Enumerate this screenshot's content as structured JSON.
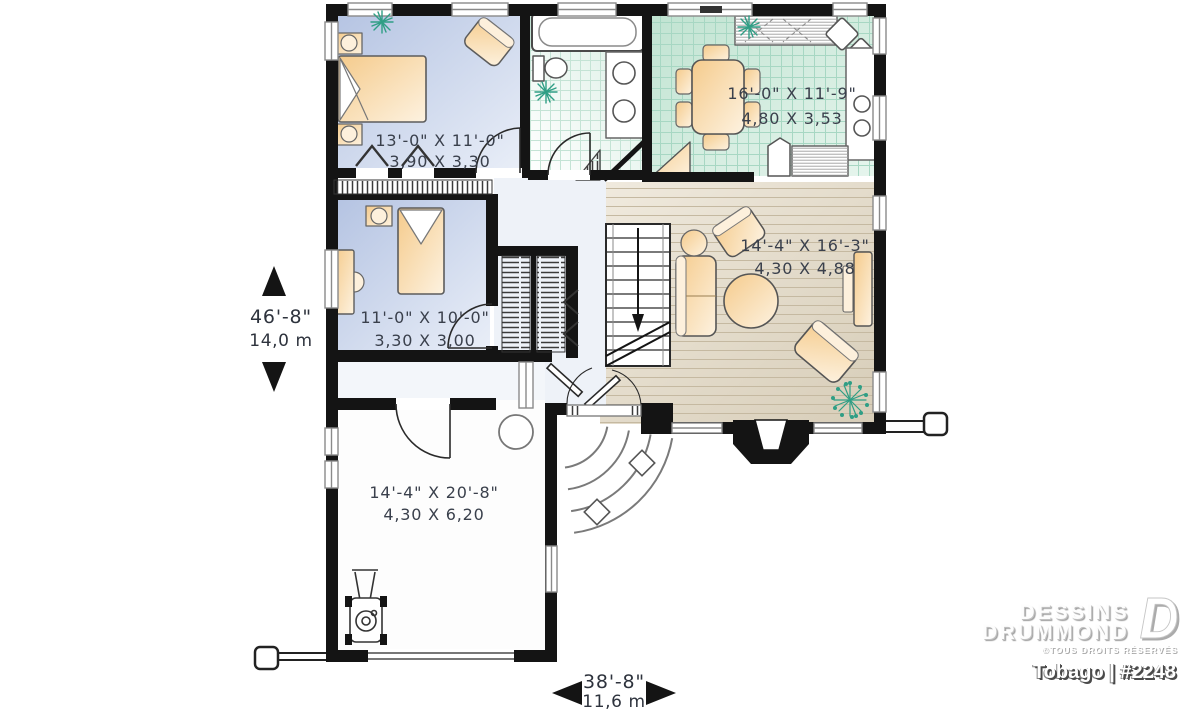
{
  "rooms": {
    "bedroom1": {
      "imperial": "13'-0\" X 11'-0\"",
      "metric": "3,90 X 3,30"
    },
    "bedroom2": {
      "imperial": "11'-0\" X 10'-0\"",
      "metric": "3,30 X 3,00"
    },
    "dining": {
      "imperial": "16'-0\" X 11'-9\"",
      "metric": "4,80 X 3,53"
    },
    "living": {
      "imperial": "14'-4\" X 16'-3\"",
      "metric": "4,30 X 4,88"
    },
    "garage": {
      "imperial": "14'-4\" X 20'-8\"",
      "metric": "4,30 X 6,20"
    }
  },
  "dimensions": {
    "depth": {
      "imperial": "46'-8\"",
      "metric": "14,0 m"
    },
    "width": {
      "imperial": "38'-8\"",
      "metric": "11,6 m"
    }
  },
  "branding": {
    "name_line1": "DESSINS",
    "name_line2": "DRUMMOND",
    "rights": "©TOUS DROITS RÉSERVÉS",
    "model": "Tobago | #2248"
  },
  "colors": {
    "wall": "#141414",
    "bedroom_floor": "#bac8e4",
    "kitchen_tile": "#cdeadd",
    "wood_floor": "#e0d8c7",
    "furniture": "#f6cf92",
    "plant_accent": "#2f9e85"
  }
}
